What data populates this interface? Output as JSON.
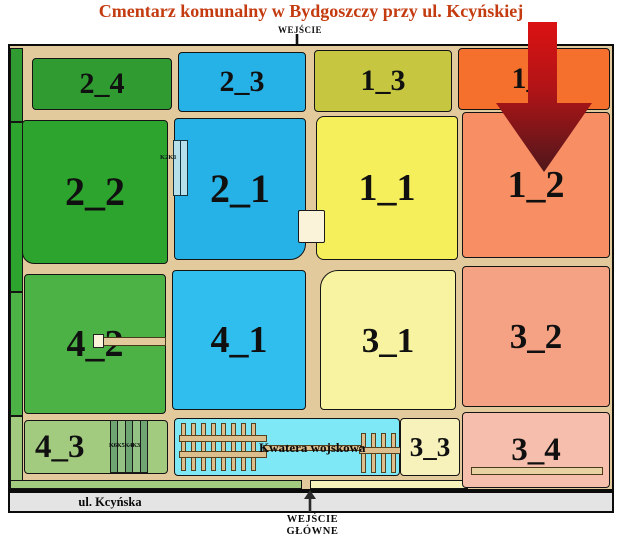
{
  "title": {
    "text": "Cmentarz komunalny w Bydgoszczy przy ul. Kcyńskiej",
    "color": "#c43b10"
  },
  "entrance_top": {
    "label": "WEJŚCIE"
  },
  "entrance_main": {
    "line1": "WEJŚCIE",
    "line2": "GŁÓWNE"
  },
  "street": {
    "label": "ul. Kcyńska",
    "color": "#e4e4e4"
  },
  "map": {
    "path_color": "#e3ca9c",
    "border_color": "#0b0b0b",
    "sections": {
      "s2_4": {
        "label": "2_4",
        "color": "#2f9b31"
      },
      "s2_3": {
        "label": "2_3",
        "color": "#27b2e7"
      },
      "s1_3": {
        "label": "1_3",
        "color": "#c6c640"
      },
      "s1_4": {
        "label": "1_4",
        "color": "#f4702c"
      },
      "s2_2": {
        "label": "2_2",
        "color": "#2da42d"
      },
      "s2_1": {
        "label": "2_1",
        "color": "#27b2e7"
      },
      "s1_1": {
        "label": "1_1",
        "color": "#f6ef5c"
      },
      "s1_2": {
        "label": "1_2",
        "color": "#f88f64"
      },
      "s4_2": {
        "label": "4_2",
        "color": "#4cb246"
      },
      "s4_1": {
        "label": "4_1",
        "color": "#2fbeee"
      },
      "s3_1": {
        "label": "3_1",
        "color": "#f8f3a0"
      },
      "s3_2": {
        "label": "3_2",
        "color": "#f5a284"
      },
      "s4_3": {
        "label": "4_3",
        "color": "#a2cb80"
      },
      "s3_3": {
        "label": "3_3",
        "color": "#f7f1bc"
      },
      "s3_4": {
        "label": "3_4",
        "color": "#f6bfad"
      }
    },
    "military_quarter": {
      "label": "Kwatera wojskowa",
      "color": "#7fe8f6"
    },
    "buildings": {
      "k2k1": {
        "label": "K2K1"
      },
      "k6k5k4k3": {
        "label": "K6K5K4K3"
      }
    },
    "highlight_arrow": {
      "points_to_section": "1_2",
      "color_top": "#db1212",
      "color_tip": "#4e171b"
    }
  }
}
